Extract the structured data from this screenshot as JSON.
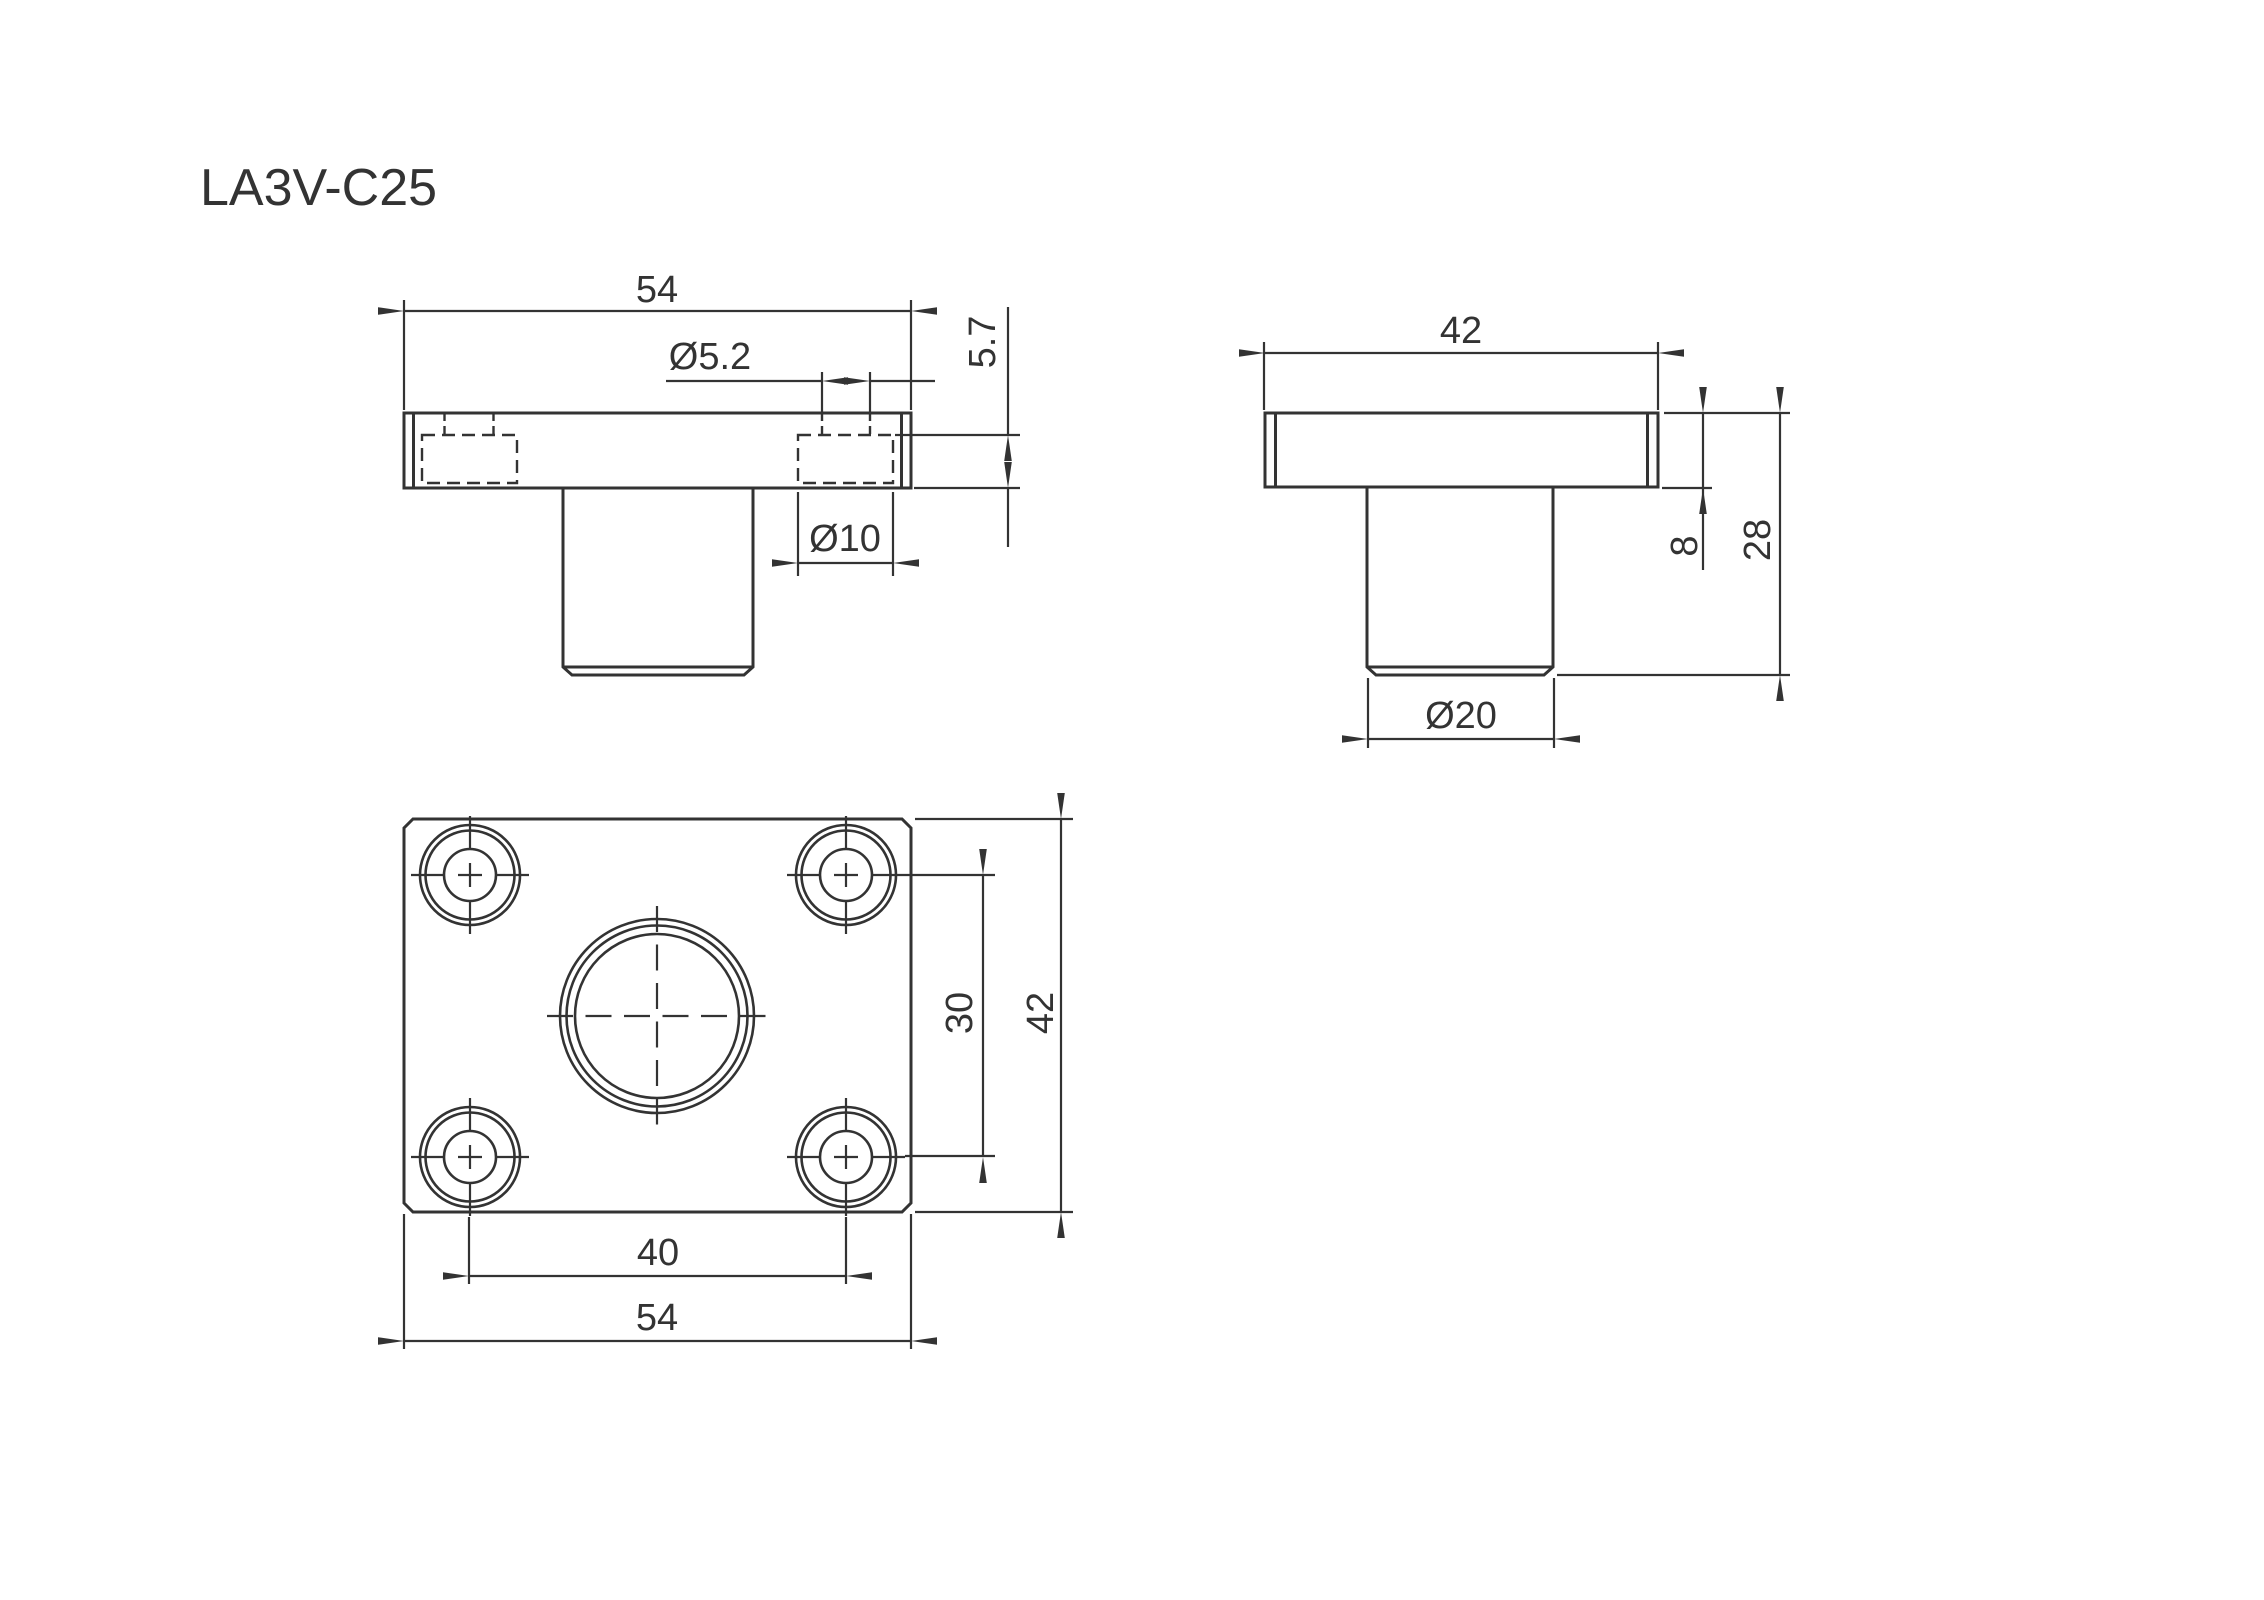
{
  "title": "LA3V-C25",
  "colors": {
    "line": "#333333",
    "background": "#ffffff"
  },
  "views": {
    "front": {
      "name": "front view",
      "dim_flange_width": "54",
      "dim_hole_diameter": "Ø5.2",
      "dim_counterbore_depth": "5.7",
      "dim_counterbore_diameter": "Ø10"
    },
    "side": {
      "name": "side view",
      "dim_flange_width": "42",
      "dim_flange_thickness": "8",
      "dim_total_height": "28",
      "dim_boss_diameter": "Ø20"
    },
    "bottom": {
      "name": "bottom view",
      "dim_hole_spacing_vertical": "30",
      "dim_plate_depth": "42",
      "dim_hole_spacing_horizontal": "40",
      "dim_plate_width": "54"
    }
  }
}
